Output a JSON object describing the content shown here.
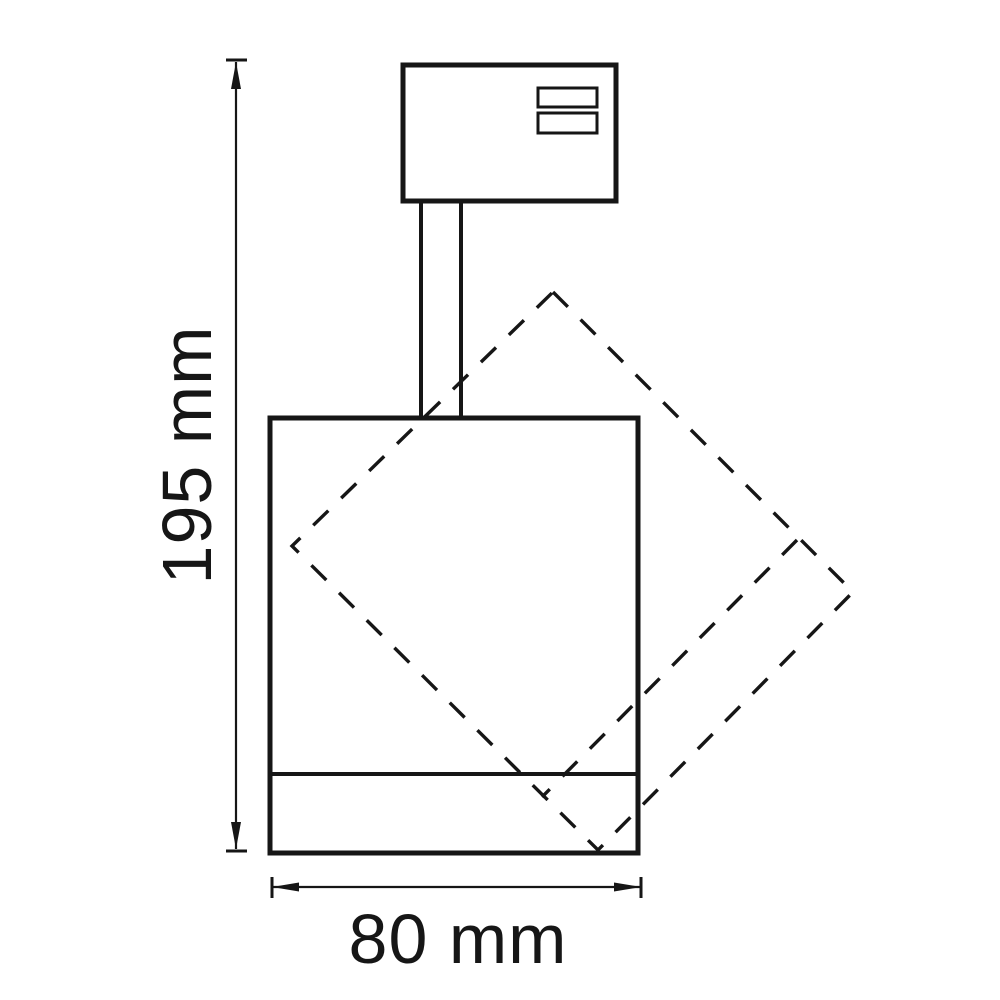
{
  "diagram": {
    "kind": "technical-dimension-drawing",
    "subject": "track spotlight side view with rotatable head outline",
    "colors": {
      "background": "#ffffff",
      "line": "#161616"
    },
    "dimensions": {
      "height": {
        "label": "195 mm",
        "value": "195",
        "unit": "mm"
      },
      "width": {
        "label": "80 mm",
        "value": "80",
        "unit": "mm"
      }
    }
  }
}
